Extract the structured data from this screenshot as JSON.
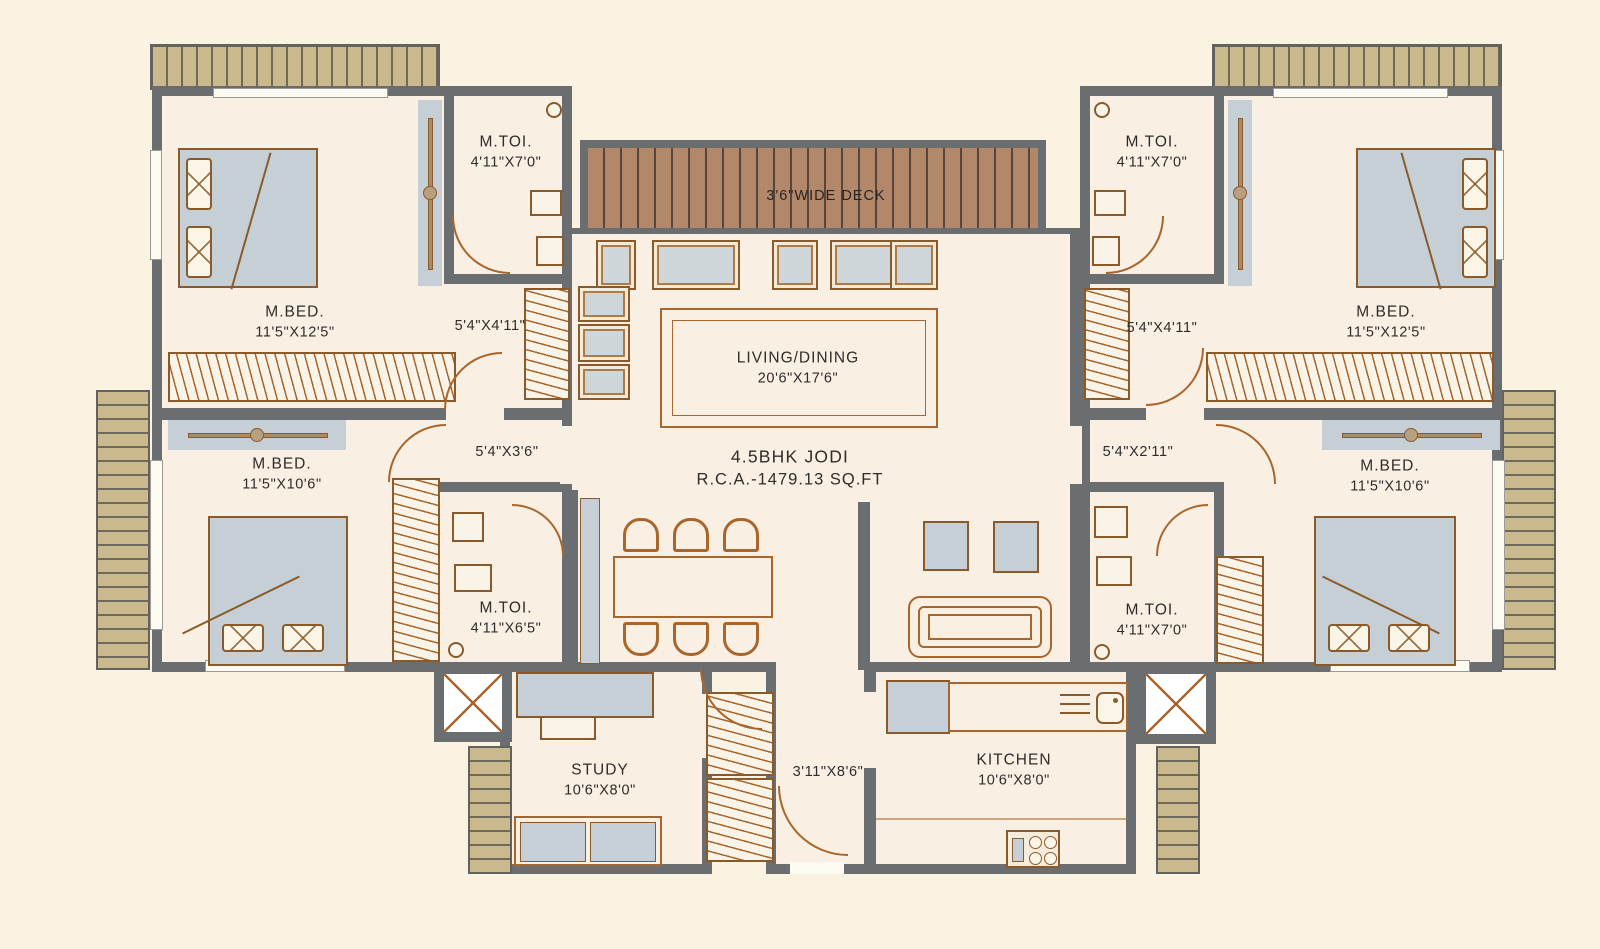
{
  "plan": {
    "title": "4.5BHK JODI",
    "area": "R.C.A.-1479.13 SQ.FT"
  },
  "rooms": {
    "deck": {
      "name": "3'6\"WIDE DECK"
    },
    "living_dining": {
      "name": "LIVING/DINING",
      "dims": "20'6\"X17'6\""
    },
    "master_bed_top_left": {
      "name": "M.BED.",
      "dims": "11'5\"X12'5\""
    },
    "master_toilet_top_left": {
      "name": "M.TOI.",
      "dims": "4'11\"X7'0\""
    },
    "passage_top_left": {
      "dims": "5'4\"X4'11\""
    },
    "master_bed_mid_left": {
      "name": "M.BED.",
      "dims": "11'5\"X10'6\""
    },
    "passage_mid_left": {
      "dims": "5'4\"X3'6\""
    },
    "master_toilet_mid_left": {
      "name": "M.TOI.",
      "dims": "4'11\"X6'5\""
    },
    "master_toilet_top_right": {
      "name": "M.TOI.",
      "dims": "4'11\"X7'0\""
    },
    "passage_top_right": {
      "dims": "5'4\"X4'11\""
    },
    "master_bed_top_right": {
      "name": "M.BED.",
      "dims": "11'5\"X12'5\""
    },
    "passage_mid_right": {
      "dims": "5'4\"X2'11\""
    },
    "master_toilet_mid_right": {
      "name": "M.TOI.",
      "dims": "4'11\"X7'0\""
    },
    "master_bed_mid_right": {
      "name": "M.BED.",
      "dims": "11'5\"X10'6\""
    },
    "study": {
      "name": "STUDY",
      "dims": "10'6\"X8'0\""
    },
    "foyer": {
      "dims": "3'11\"X8'6\""
    },
    "kitchen": {
      "name": "KITCHEN",
      "dims": "10'6\"X8'0\""
    }
  },
  "palette": {
    "background": "#faf3e2",
    "floor": "#f9efe3",
    "wall": "#6a6e71",
    "furniture_gray": "#c6cfd6",
    "outline_brown": "#a9662c",
    "deck_wood": "#b2876a",
    "ledge_tan": "#c9b98c",
    "text": "#2e2d2b"
  }
}
